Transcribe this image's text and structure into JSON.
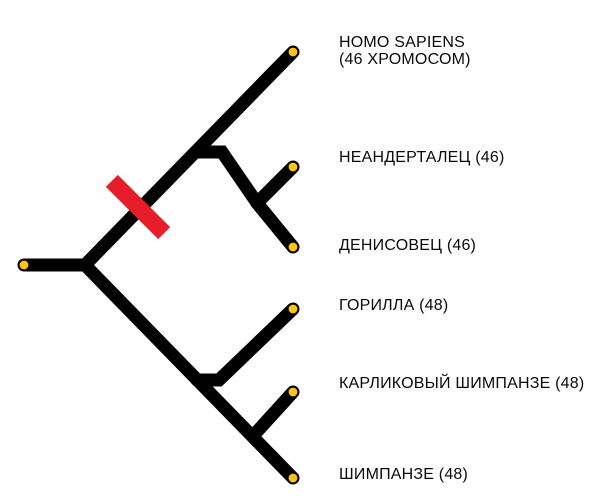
{
  "canvas": {
    "width": 600,
    "height": 504,
    "background_color": "#ffffff"
  },
  "style": {
    "branch_color": "#000000",
    "tip_dot_fill": "#ffc411",
    "tip_dot_stroke": "#000000",
    "fusion_marker_color": "#e61e29",
    "label_color": "#0a0a0a"
  },
  "tree": {
    "type": "phylogenetic-tree",
    "tips": [
      {
        "id": "homo-sapiens",
        "label_lines": [
          "HOMO SAPIENS",
          "(46 ХРОМОСОМ)"
        ],
        "chromosomes": 46
      },
      {
        "id": "neanderthal",
        "label_lines": [
          "НЕАНДЕРТАЛЕЦ (46)"
        ],
        "chromosomes": 46
      },
      {
        "id": "denisovan",
        "label_lines": [
          "ДЕНИСОВЕЦ (46)"
        ],
        "chromosomes": 46
      },
      {
        "id": "gorilla",
        "label_lines": [
          "ГОРИЛЛА (48)"
        ],
        "chromosomes": 48
      },
      {
        "id": "bonobo",
        "label_lines": [
          "КАРЛИКОВЫЙ ШИМПАНЗЕ (48)"
        ],
        "chromosomes": 48
      },
      {
        "id": "chimpanzee",
        "label_lines": [
          "ШИМПАНЗЕ (48)"
        ],
        "chromosomes": 48
      }
    ],
    "marker": {
      "id": "chromosome-fusion-marker"
    }
  }
}
